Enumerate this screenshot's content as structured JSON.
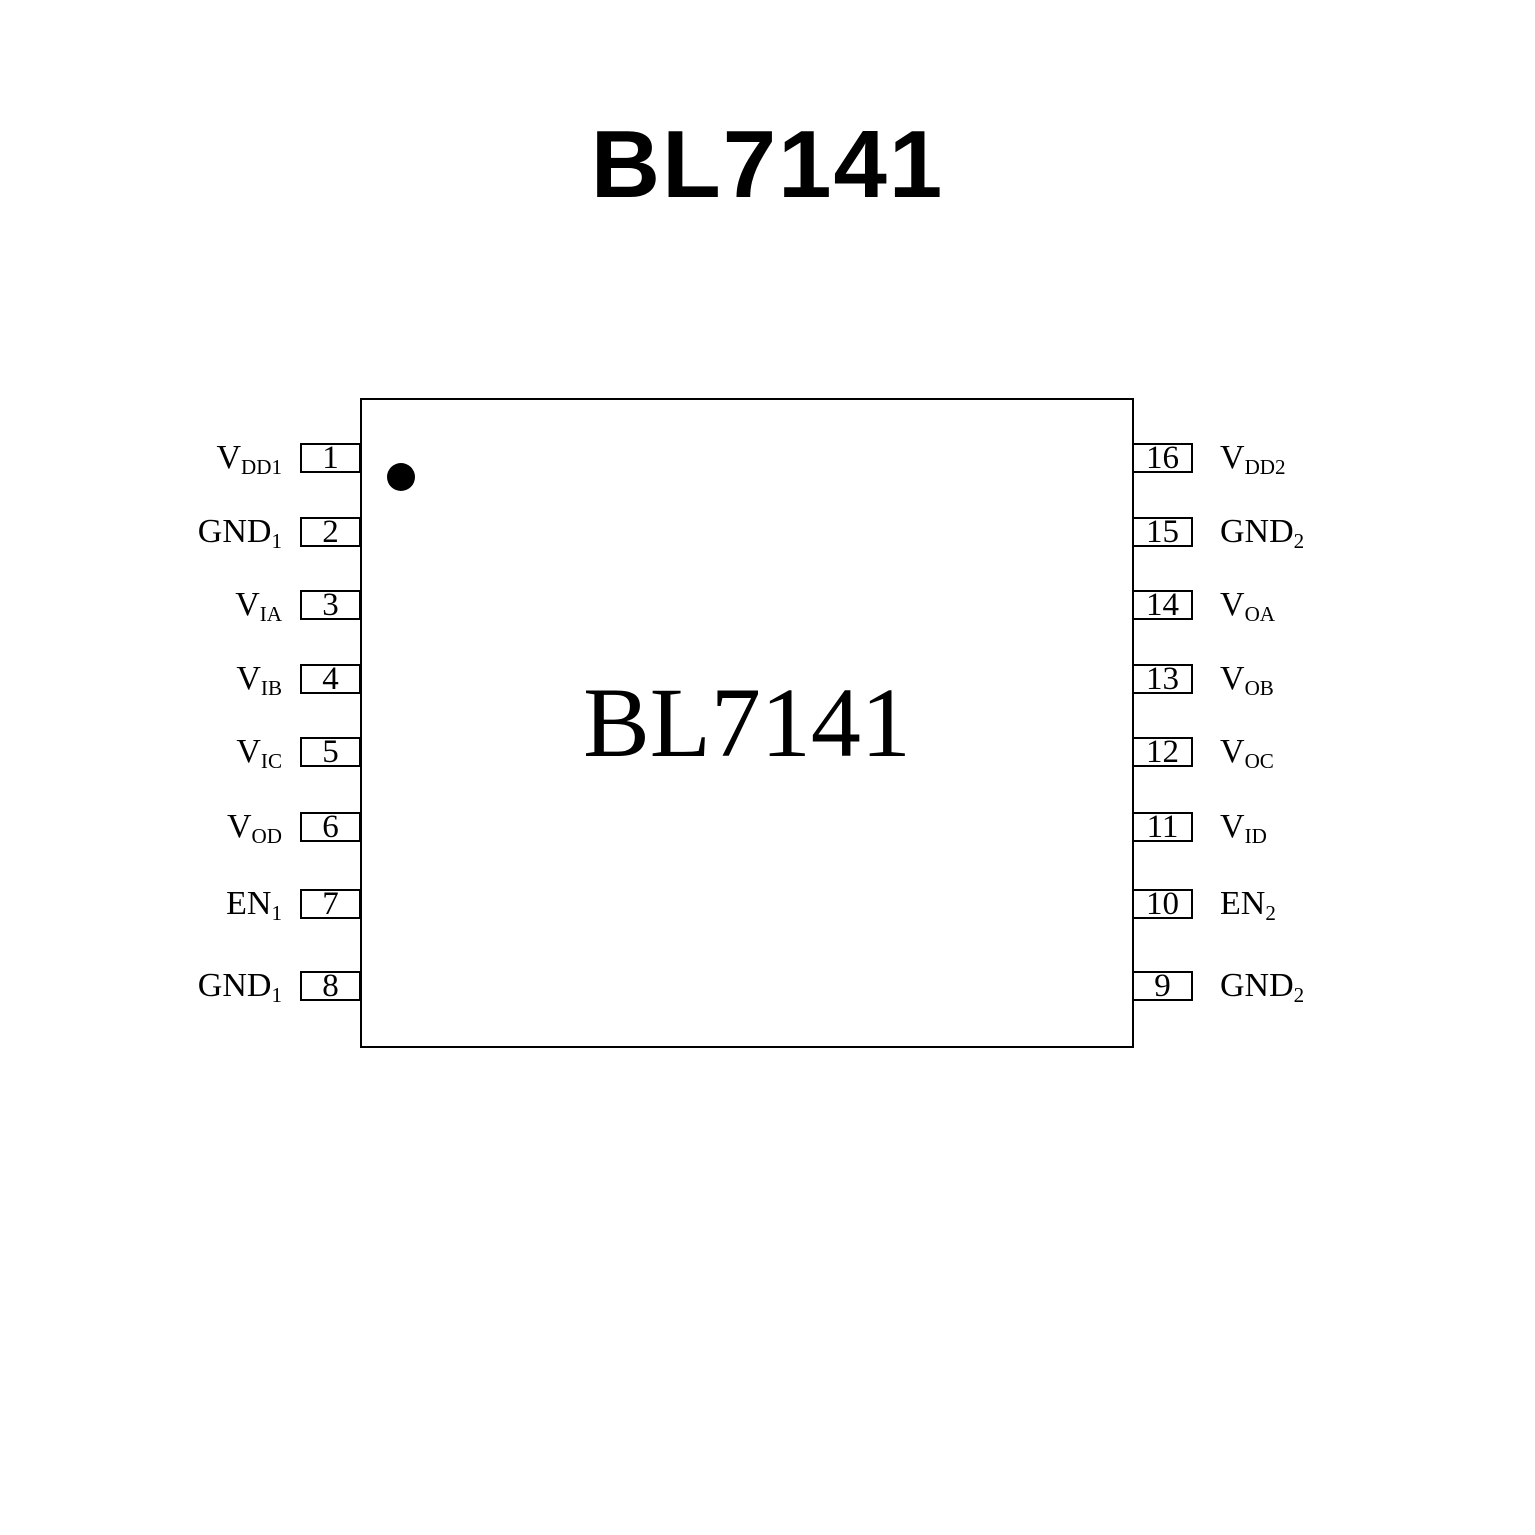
{
  "page_title": "BL7141",
  "colors": {
    "ink": "#000000",
    "background": "#ffffff"
  },
  "chip": {
    "label": "BL7141",
    "left_pins": [
      {
        "number": "1",
        "base": "V",
        "sub": "DD1"
      },
      {
        "number": "2",
        "base": "GND",
        "sub": "1"
      },
      {
        "number": "3",
        "base": "V",
        "sub": "IA"
      },
      {
        "number": "4",
        "base": "V",
        "sub": "IB"
      },
      {
        "number": "5",
        "base": "V",
        "sub": "IC"
      },
      {
        "number": "6",
        "base": "V",
        "sub": "OD"
      },
      {
        "number": "7",
        "base": "EN",
        "sub": "1"
      },
      {
        "number": "8",
        "base": "GND",
        "sub": "1"
      }
    ],
    "right_pins": [
      {
        "number": "16",
        "base": "V",
        "sub": "DD2"
      },
      {
        "number": "15",
        "base": "GND",
        "sub": "2"
      },
      {
        "number": "14",
        "base": "V",
        "sub": "OA"
      },
      {
        "number": "13",
        "base": "V",
        "sub": "OB"
      },
      {
        "number": "12",
        "base": "V",
        "sub": "OC"
      },
      {
        "number": "11",
        "base": "V",
        "sub": "ID"
      },
      {
        "number": "10",
        "base": "EN",
        "sub": "2"
      },
      {
        "number": "9",
        "base": "GND",
        "sub": "2"
      }
    ]
  }
}
